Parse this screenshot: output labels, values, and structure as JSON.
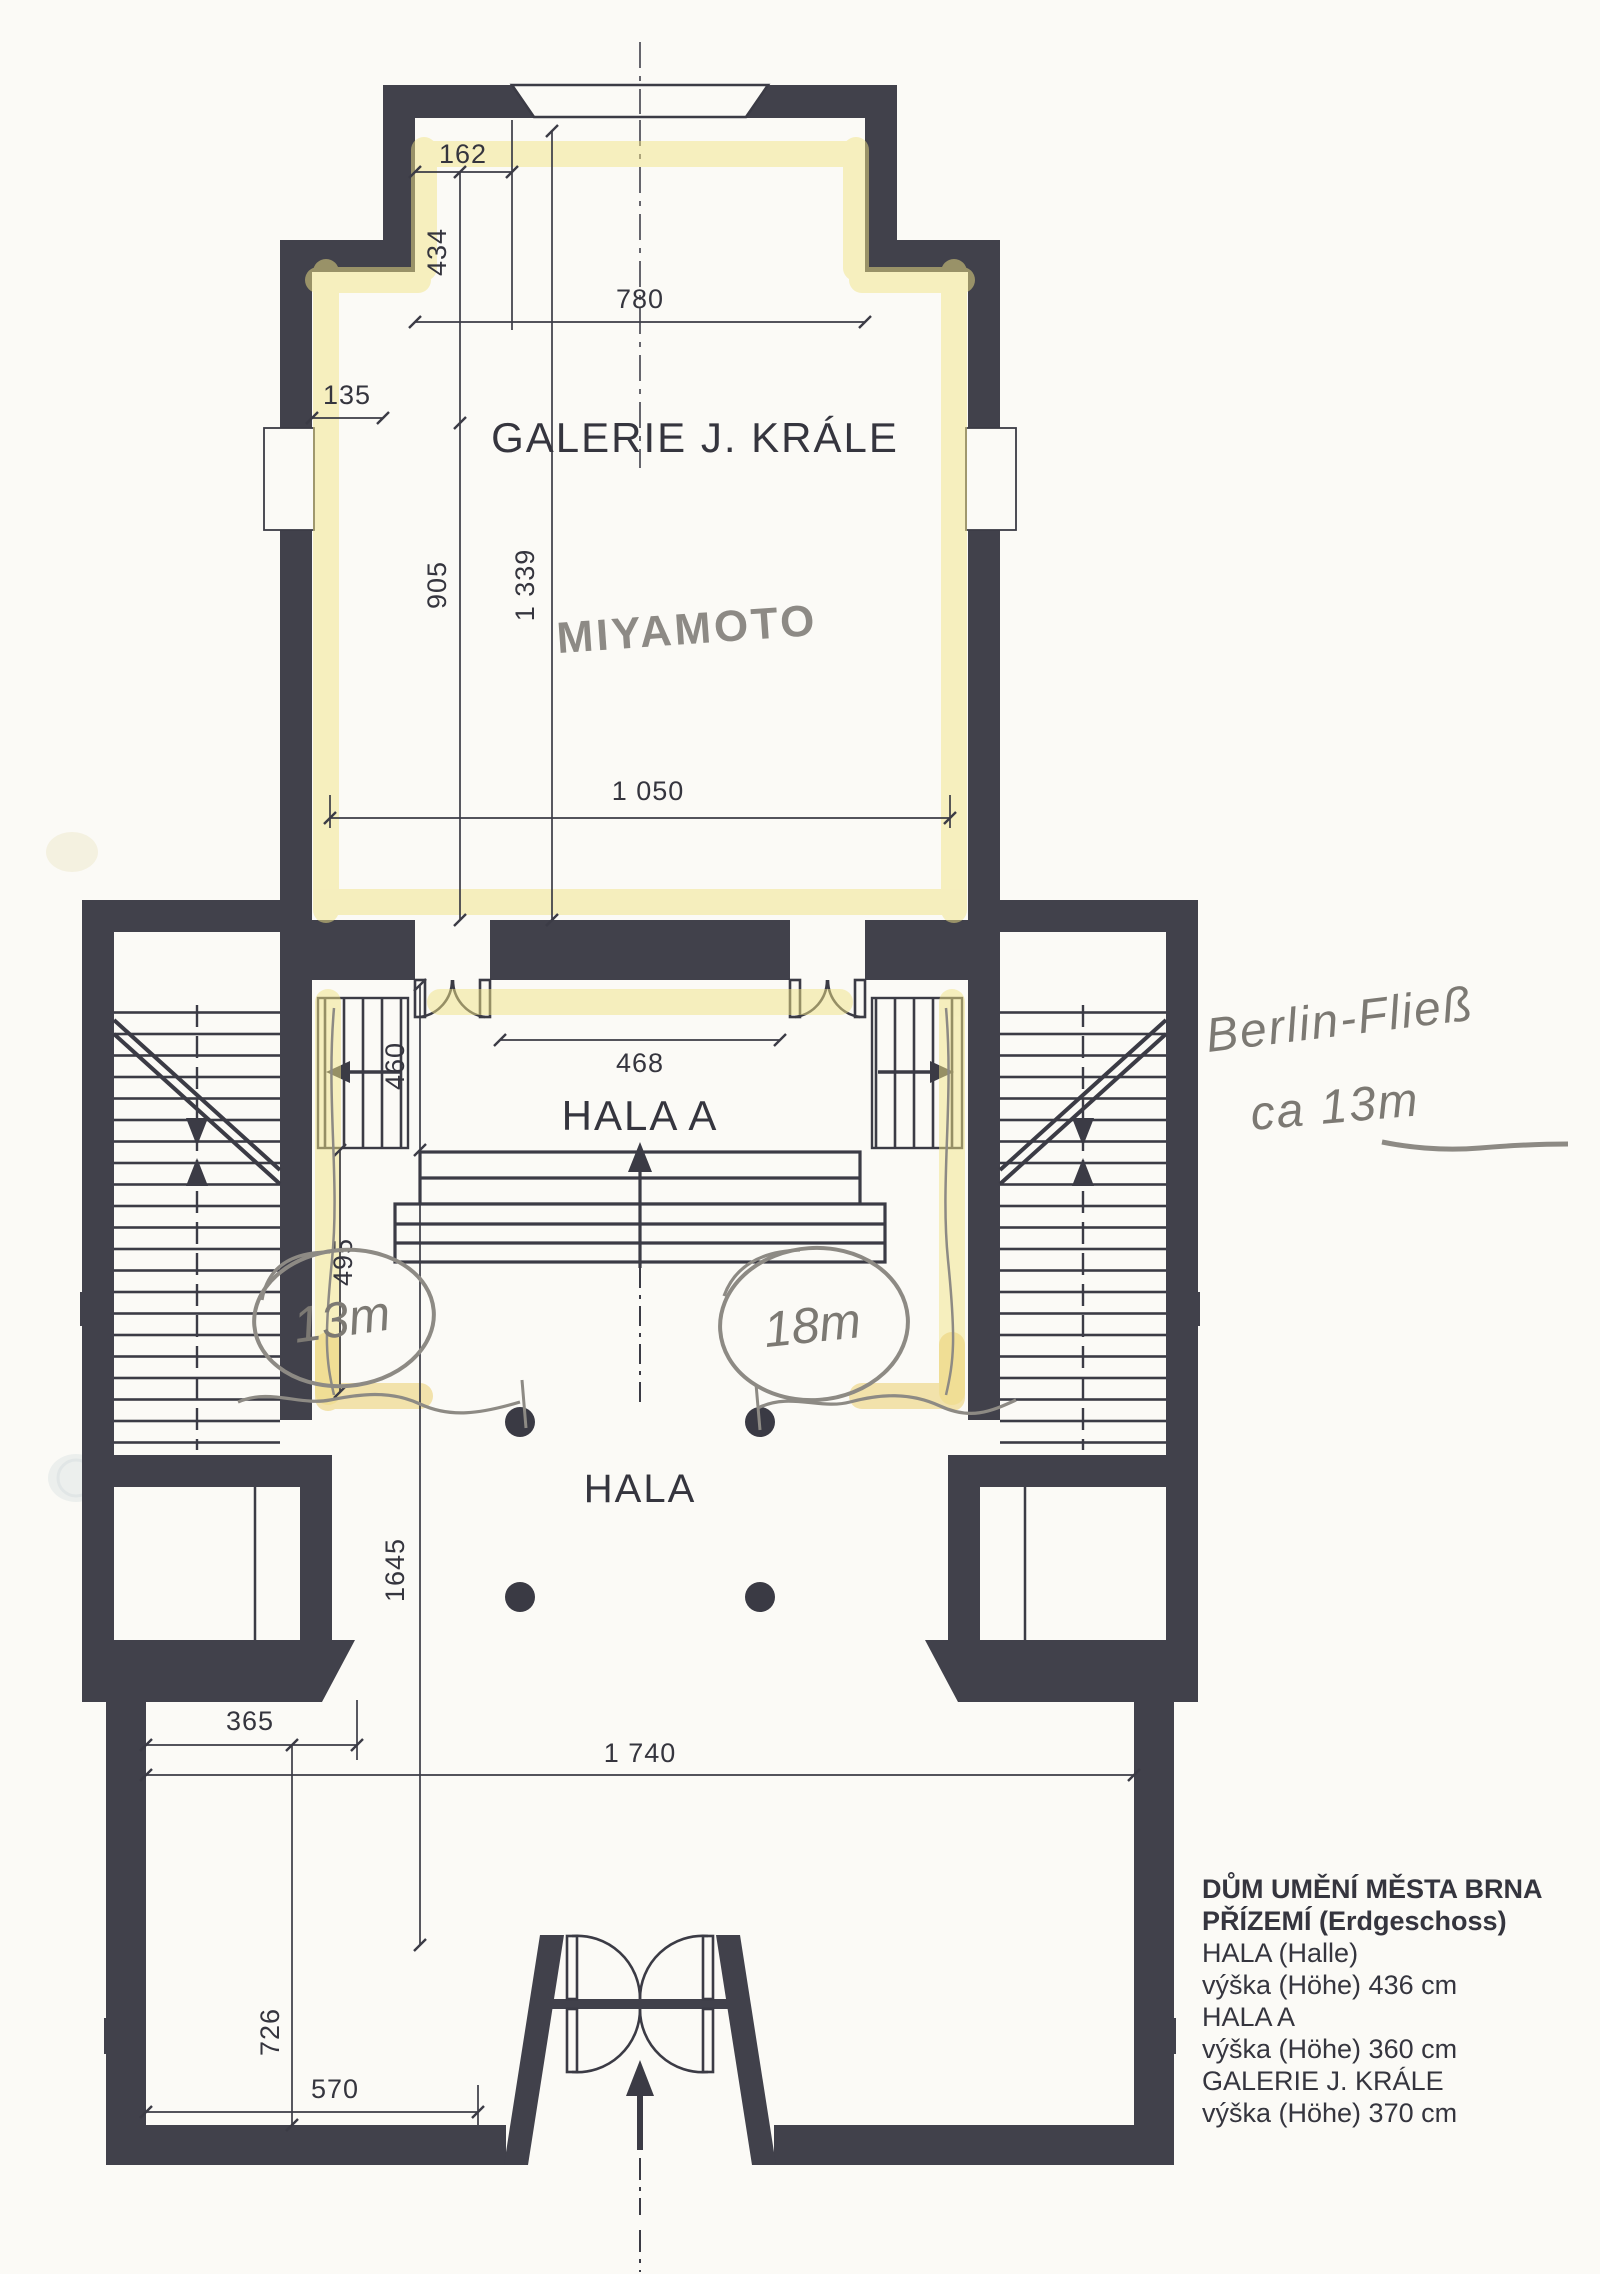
{
  "plan": {
    "rooms": {
      "galerie": "GALERIE J. KRÁLE",
      "hala_a": "HALA A",
      "hala": "HALA"
    },
    "dims": {
      "d162": "162",
      "d434": "434",
      "d780": "780",
      "d135": "135",
      "d905": "905",
      "d1339": "1 339",
      "d1050": "1 050",
      "d468": "468",
      "d460": "460",
      "d495": "495",
      "d1645": "1645",
      "d365": "365",
      "d1740": "1 740",
      "d726": "726",
      "d570": "570"
    },
    "handwriting": {
      "artist": "MIYAMOTO",
      "note_line1": "Berlin-Fließ",
      "note_line2": "ca 13m",
      "wall_left": "13m",
      "wall_right": "18m"
    },
    "info_block": {
      "line1": "DŮM UMĚNÍ MĚSTA BRNA",
      "line2": "PŘÍZEMÍ (Erdgeschoss)",
      "line3": "HALA (Halle)",
      "line4": "výška (Höhe) 436 cm",
      "line5": "HALA A",
      "line6": "výška (Höhe) 360 cm",
      "line7": "GALERIE J. KRÁLE",
      "line8": "výška (Höhe) 370 cm"
    },
    "colors": {
      "wall": "#41414b",
      "line": "#3b3b45",
      "highlighter": "#f1e386",
      "pencil": "#8d8a84",
      "paper": "#fbfaf6"
    }
  }
}
